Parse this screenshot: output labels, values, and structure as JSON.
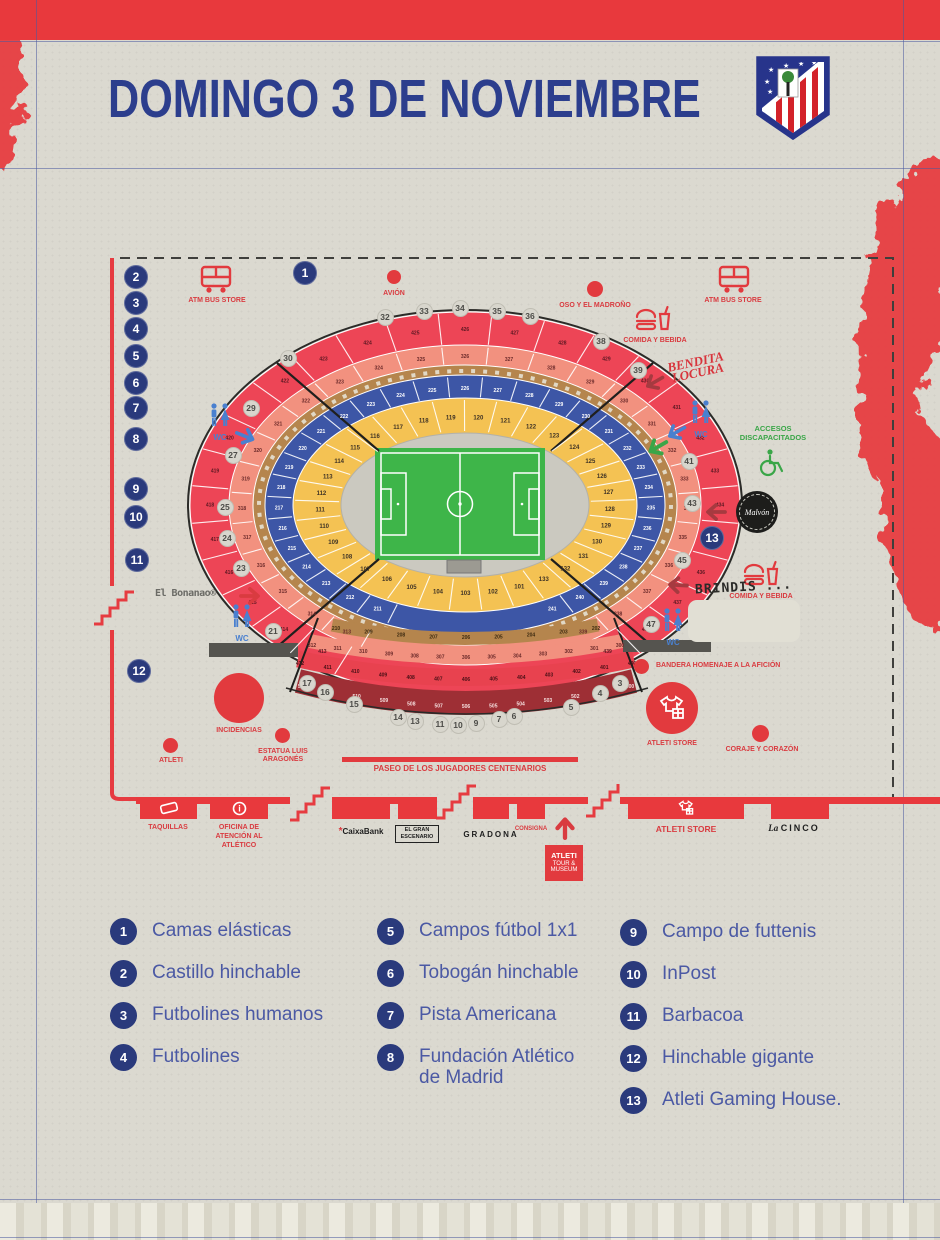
{
  "header": {
    "title": "DOMINGO 3 DE NOVIEMBRE"
  },
  "colors": {
    "accent_red": "#e23a3e",
    "navy": "#2a3a7c",
    "title_navy": "#2c3e8d",
    "tier100_yellow": "#f4c253",
    "tier200_blue": "#3d56a6",
    "tier300_salmon": "#f2917f",
    "tier400_red": "#ed4556",
    "tier500_maroon": "#9e2f35",
    "walkway_tan": "#b5854d",
    "pitch_green": "#3eb549",
    "paper": "#dbd9d0"
  },
  "map": {
    "labels": {
      "atm_bus": "ATM BUS STORE",
      "avion": "AVIÓN",
      "oso": "OSO Y EL MADROÑO",
      "comida": "COMIDA Y BEBIDA",
      "bendita_1": "BENDITA",
      "bendita_2": "LOCURA",
      "wc": "WC",
      "accesos": "ACCESOS DISCAPACITADOS",
      "malvon": "Malvón",
      "brindis": "BRINDIS ...",
      "bonanao": "El Bonanao®",
      "incidencias": "INCIDENCIAS",
      "estatua": "ESTATUA LUIS ARAGONÉS",
      "atleti": "ATLETI",
      "bandera": "BANDERA HOMENAJE A LA AFICIÓN",
      "atleti_store": "ATLETI STORE",
      "coraje": "CORAJE Y CORAZÓN",
      "paseo": "PASEO DE LOS JUGADORES CENTENARIOS"
    },
    "area_numbers": [
      {
        "n": "1",
        "x": 305,
        "y": 273
      },
      {
        "n": "2",
        "x": 136,
        "y": 277
      },
      {
        "n": "3",
        "x": 136,
        "y": 303
      },
      {
        "n": "4",
        "x": 136,
        "y": 329
      },
      {
        "n": "5",
        "x": 136,
        "y": 356
      },
      {
        "n": "6",
        "x": 136,
        "y": 383
      },
      {
        "n": "7",
        "x": 136,
        "y": 408
      },
      {
        "n": "8",
        "x": 136,
        "y": 439
      },
      {
        "n": "9",
        "x": 136,
        "y": 489
      },
      {
        "n": "10",
        "x": 136,
        "y": 517
      },
      {
        "n": "11",
        "x": 137,
        "y": 560
      },
      {
        "n": "12",
        "x": 139,
        "y": 671
      },
      {
        "n": "13",
        "x": 712,
        "y": 538
      }
    ],
    "gates": [
      {
        "n": "30",
        "x": 288,
        "y": 358
      },
      {
        "n": "29",
        "x": 251,
        "y": 408
      },
      {
        "n": "27",
        "x": 233,
        "y": 455
      },
      {
        "n": "25",
        "x": 225,
        "y": 507
      },
      {
        "n": "24",
        "x": 227,
        "y": 538
      },
      {
        "n": "23",
        "x": 241,
        "y": 568
      },
      {
        "n": "21",
        "x": 273,
        "y": 631
      },
      {
        "n": "32",
        "x": 385,
        "y": 317
      },
      {
        "n": "33",
        "x": 424,
        "y": 311
      },
      {
        "n": "34",
        "x": 460,
        "y": 308
      },
      {
        "n": "35",
        "x": 497,
        "y": 311
      },
      {
        "n": "36",
        "x": 530,
        "y": 316
      },
      {
        "n": "38",
        "x": 601,
        "y": 341
      },
      {
        "n": "39",
        "x": 638,
        "y": 370
      },
      {
        "n": "41",
        "x": 689,
        "y": 461
      },
      {
        "n": "43",
        "x": 692,
        "y": 503
      },
      {
        "n": "45",
        "x": 682,
        "y": 560
      },
      {
        "n": "47",
        "x": 651,
        "y": 624
      },
      {
        "n": "17",
        "x": 307,
        "y": 683
      },
      {
        "n": "16",
        "x": 325,
        "y": 692
      },
      {
        "n": "15",
        "x": 354,
        "y": 704
      },
      {
        "n": "14",
        "x": 398,
        "y": 717
      },
      {
        "n": "13",
        "x": 415,
        "y": 721
      },
      {
        "n": "11",
        "x": 440,
        "y": 724
      },
      {
        "n": "10",
        "x": 458,
        "y": 725
      },
      {
        "n": "9",
        "x": 476,
        "y": 723
      },
      {
        "n": "7",
        "x": 499,
        "y": 719
      },
      {
        "n": "6",
        "x": 514,
        "y": 716
      },
      {
        "n": "5",
        "x": 571,
        "y": 707
      },
      {
        "n": "4",
        "x": 600,
        "y": 693
      },
      {
        "n": "3",
        "x": 620,
        "y": 683
      }
    ],
    "stadium": {
      "cx": 465,
      "cy": 505
    },
    "sections_rings": [
      {
        "name": "tier-100",
        "from": 101,
        "to": 133,
        "rx": 145,
        "ry": 88,
        "a0": 68,
        "a1": 428,
        "text": "#3f3325",
        "tick_in": [
          126,
          74
        ],
        "tick_out": [
          170,
          105
        ]
      },
      {
        "name": "tier-200",
        "from": 211,
        "to": 241,
        "rx": 186,
        "ry": 117,
        "a0": 118,
        "a1": 422,
        "text": "#ffffff",
        "tick_in": [
          174,
          108
        ],
        "tick_out": [
          198,
          128
        ]
      },
      {
        "name": "tier-300",
        "from": 313,
        "to": 339,
        "rx": 223,
        "ry": 149,
        "a0": 122,
        "a1": 418,
        "text": "#6b2a2a",
        "tick_in": [
          214,
          141
        ],
        "tick_out": [
          234,
          158
        ]
      },
      {
        "name": "tier-400",
        "from": 413,
        "to": 439,
        "rx": 255,
        "ry": 176,
        "a0": 124,
        "a1": 416,
        "text": "#5c1822",
        "tick_in": [
          238,
          161
        ],
        "tick_out": [
          274,
          192
        ]
      }
    ],
    "south_bands": [
      {
        "from": 210,
        "to": 202,
        "x1": 336,
        "x2": 596,
        "y": 628,
        "dip": 9,
        "text": "#3f2c12"
      },
      {
        "from": 312,
        "to": 300,
        "x1": 312,
        "x2": 620,
        "y": 645,
        "dip": 12,
        "text": "#6b2a2a"
      },
      {
        "from": 412,
        "to": 400,
        "x1": 300,
        "x2": 632,
        "y": 663,
        "dip": 16,
        "text": "#4a1016"
      },
      {
        "from": 512,
        "to": 500,
        "x1": 302,
        "x2": 630,
        "y": 686,
        "dip": 20,
        "text": "#f5dede"
      }
    ]
  },
  "facilities": {
    "taquillas": "TAQUILLAS",
    "oficina": "OFICINA DE ATENCIÓN AL ATLÉTICO",
    "caixa_mark": "*",
    "caixabank": "CaixaBank",
    "gran_escenario": "EL GRAN ESCENARIO",
    "gradona": "GRADONA",
    "consigna": "CONSIGNA",
    "tour_1": "ATLETI",
    "tour_2": "TOUR &",
    "tour_3": "MUSEUM",
    "cinco_1": "La",
    "cinco_2": "CINCO"
  },
  "legend": {
    "items": [
      {
        "n": "1",
        "label": "Camas elásticas"
      },
      {
        "n": "2",
        "label": "Castillo hinchable"
      },
      {
        "n": "3",
        "label": "Futbolines humanos"
      },
      {
        "n": "4",
        "label": "Futbolines"
      },
      {
        "n": "5",
        "label": "Campos fútbol 1x1"
      },
      {
        "n": "6",
        "label": "Tobogán hinchable"
      },
      {
        "n": "7",
        "label": "Pista Americana"
      },
      {
        "n": "8",
        "label": "Fundación Atlético de Madrid"
      },
      {
        "n": "9",
        "label": "Campo de futtenis"
      },
      {
        "n": "10",
        "label": "InPost"
      },
      {
        "n": "11",
        "label": "Barbacoa"
      },
      {
        "n": "12",
        "label": "Hinchable gigante"
      },
      {
        "n": "13",
        "label": "Atleti Gaming House."
      }
    ]
  }
}
